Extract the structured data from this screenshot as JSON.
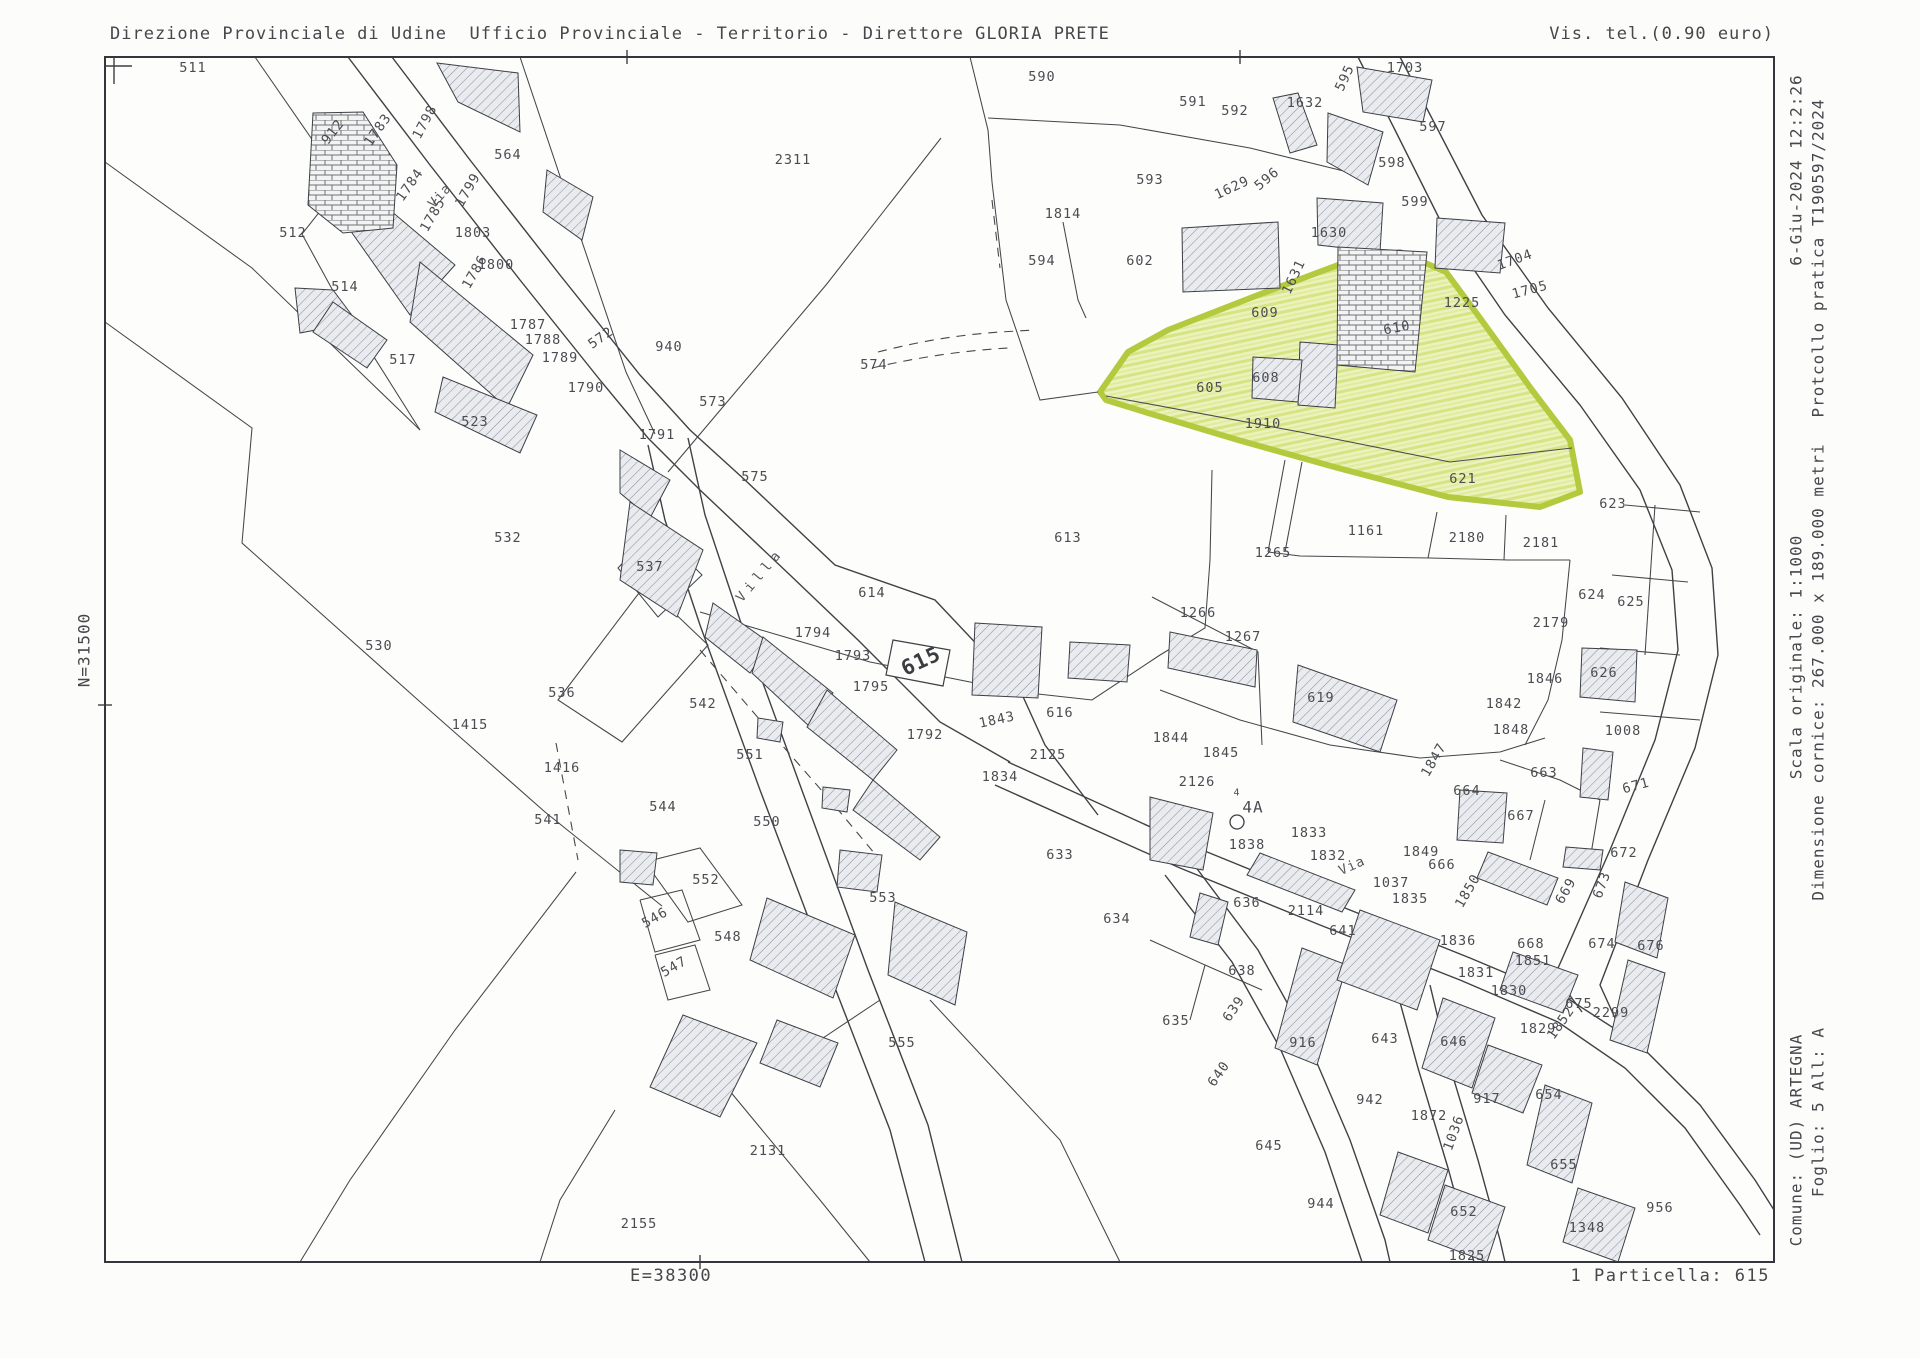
{
  "header": {
    "title_left": "Direzione Provinciale di Udine  Ufficio Provinciale - Territorio - Direttore GLORIA PRETE",
    "title_right": "Vis. tel.(0.90 euro)"
  },
  "right_margin": {
    "date_time": "6-Giu-2024 12:2:26",
    "protocol": "Protcollo pratica T190597/2024",
    "scale": "Scala originale: 1:1000",
    "frame_size": "Dimensione cornice: 267.000 x 189.000 metri",
    "comune": "Comune: (UD) ARTEGNA",
    "foglio": "Foglio: 5 All: A"
  },
  "left_margin": {
    "north_coord": "N=31500"
  },
  "footer": {
    "east_coord": "E=38300",
    "particella": "1 Particella: 615"
  },
  "map": {
    "highlighted_parcel": "621",
    "target_parcel": "615",
    "highlight_fill": "#e7efad",
    "highlight_stroke": "#b3c93e",
    "line_color": "#3f4146",
    "labels": [
      {
        "t": "511",
        "x": 193,
        "y": 68
      },
      {
        "t": "912",
        "x": 333,
        "y": 132,
        "r": -52
      },
      {
        "t": "1783",
        "x": 378,
        "y": 130,
        "r": -55
      },
      {
        "t": "1798",
        "x": 425,
        "y": 122,
        "r": -62
      },
      {
        "t": "564",
        "x": 508,
        "y": 155
      },
      {
        "t": "1784",
        "x": 410,
        "y": 185,
        "r": -55
      },
      {
        "t": "Via",
        "x": 440,
        "y": 196,
        "r": -48,
        "cls": "road-label"
      },
      {
        "t": "1799",
        "x": 468,
        "y": 190,
        "r": -60
      },
      {
        "t": "512",
        "x": 293,
        "y": 233
      },
      {
        "t": "1785",
        "x": 433,
        "y": 215,
        "r": -60
      },
      {
        "t": "1803",
        "x": 473,
        "y": 233
      },
      {
        "t": "1800",
        "x": 496,
        "y": 265
      },
      {
        "t": "514",
        "x": 345,
        "y": 287
      },
      {
        "t": "1786",
        "x": 475,
        "y": 272,
        "r": -60
      },
      {
        "t": "1787",
        "x": 528,
        "y": 325
      },
      {
        "t": "1788",
        "x": 543,
        "y": 340
      },
      {
        "t": "1789",
        "x": 560,
        "y": 358
      },
      {
        "t": "572",
        "x": 601,
        "y": 338,
        "r": -35
      },
      {
        "t": "517",
        "x": 403,
        "y": 360
      },
      {
        "t": "1790",
        "x": 586,
        "y": 388
      },
      {
        "t": "523",
        "x": 475,
        "y": 422
      },
      {
        "t": "590",
        "x": 1042,
        "y": 77
      },
      {
        "t": "2311",
        "x": 793,
        "y": 160
      },
      {
        "t": "593",
        "x": 1150,
        "y": 180
      },
      {
        "t": "1814",
        "x": 1063,
        "y": 214
      },
      {
        "t": "594",
        "x": 1042,
        "y": 261
      },
      {
        "t": "602",
        "x": 1140,
        "y": 261
      },
      {
        "t": "940",
        "x": 669,
        "y": 347
      },
      {
        "t": "573",
        "x": 713,
        "y": 402
      },
      {
        "t": "574",
        "x": 874,
        "y": 365
      },
      {
        "t": "1791",
        "x": 657,
        "y": 435
      },
      {
        "t": "575",
        "x": 755,
        "y": 477
      },
      {
        "t": "591",
        "x": 1193,
        "y": 102
      },
      {
        "t": "592",
        "x": 1235,
        "y": 111
      },
      {
        "t": "1632",
        "x": 1305,
        "y": 103
      },
      {
        "t": "595",
        "x": 1345,
        "y": 78,
        "r": -65
      },
      {
        "t": "1703",
        "x": 1405,
        "y": 68
      },
      {
        "t": "597",
        "x": 1433,
        "y": 127
      },
      {
        "t": "598",
        "x": 1392,
        "y": 163
      },
      {
        "t": "1629",
        "x": 1232,
        "y": 188,
        "r": -25
      },
      {
        "t": "596",
        "x": 1267,
        "y": 179,
        "r": -40
      },
      {
        "t": "599",
        "x": 1415,
        "y": 202
      },
      {
        "t": "1630",
        "x": 1329,
        "y": 233
      },
      {
        "t": "1631",
        "x": 1294,
        "y": 277,
        "r": -65
      },
      {
        "t": "609",
        "x": 1265,
        "y": 313
      },
      {
        "t": "1704",
        "x": 1515,
        "y": 260,
        "r": -20
      },
      {
        "t": "1705",
        "x": 1530,
        "y": 290,
        "r": -15
      },
      {
        "t": "1225",
        "x": 1462,
        "y": 303
      },
      {
        "t": "610",
        "x": 1397,
        "y": 328,
        "r": -10
      },
      {
        "t": "608",
        "x": 1266,
        "y": 378
      },
      {
        "t": "605",
        "x": 1210,
        "y": 388
      },
      {
        "t": "1910",
        "x": 1263,
        "y": 424
      },
      {
        "t": "621",
        "x": 1463,
        "y": 479
      },
      {
        "t": "623",
        "x": 1613,
        "y": 504
      },
      {
        "t": "532",
        "x": 508,
        "y": 538
      },
      {
        "t": "537",
        "x": 650,
        "y": 567
      },
      {
        "t": "530",
        "x": 379,
        "y": 646
      },
      {
        "t": "536",
        "x": 562,
        "y": 693
      },
      {
        "t": "1415",
        "x": 470,
        "y": 725
      },
      {
        "t": "1416",
        "x": 562,
        "y": 768
      },
      {
        "t": "541",
        "x": 548,
        "y": 820
      },
      {
        "t": "Villa",
        "x": 760,
        "y": 575,
        "r": -50,
        "cls": "road-label",
        "sp": 5
      },
      {
        "t": "613",
        "x": 1068,
        "y": 538
      },
      {
        "t": "614",
        "x": 872,
        "y": 593
      },
      {
        "t": "1794",
        "x": 813,
        "y": 633
      },
      {
        "t": "1793",
        "x": 853,
        "y": 656
      },
      {
        "t": "1795",
        "x": 871,
        "y": 687
      },
      {
        "t": "615",
        "x": 921,
        "y": 661,
        "r": -25,
        "s": 21,
        "cls": "target-parcel-label"
      },
      {
        "t": "542",
        "x": 703,
        "y": 704
      },
      {
        "t": "1792",
        "x": 925,
        "y": 735
      },
      {
        "t": "551",
        "x": 750,
        "y": 755
      },
      {
        "t": "616",
        "x": 1060,
        "y": 713
      },
      {
        "t": "1843",
        "x": 997,
        "y": 720,
        "r": -12
      },
      {
        "t": "544",
        "x": 663,
        "y": 807
      },
      {
        "t": "550",
        "x": 767,
        "y": 822
      },
      {
        "t": "2125",
        "x": 1048,
        "y": 755
      },
      {
        "t": "1834",
        "x": 1000,
        "y": 777
      },
      {
        "t": "1161",
        "x": 1366,
        "y": 531
      },
      {
        "t": "2180",
        "x": 1467,
        "y": 538
      },
      {
        "t": "2181",
        "x": 1541,
        "y": 543
      },
      {
        "t": "1265",
        "x": 1273,
        "y": 553
      },
      {
        "t": "624",
        "x": 1592,
        "y": 595
      },
      {
        "t": "625",
        "x": 1631,
        "y": 602
      },
      {
        "t": "2179",
        "x": 1551,
        "y": 623
      },
      {
        "t": "1266",
        "x": 1198,
        "y": 613
      },
      {
        "t": "1267",
        "x": 1243,
        "y": 637
      },
      {
        "t": "626",
        "x": 1604,
        "y": 673
      },
      {
        "t": "1846",
        "x": 1545,
        "y": 679
      },
      {
        "t": "619",
        "x": 1321,
        "y": 698
      },
      {
        "t": "1842",
        "x": 1504,
        "y": 704
      },
      {
        "t": "1848",
        "x": 1511,
        "y": 730
      },
      {
        "t": "1008",
        "x": 1623,
        "y": 731
      },
      {
        "t": "1844",
        "x": 1171,
        "y": 738
      },
      {
        "t": "1845",
        "x": 1221,
        "y": 753
      },
      {
        "t": "1847",
        "x": 1434,
        "y": 760,
        "r": -60
      },
      {
        "t": "2126",
        "x": 1197,
        "y": 782
      },
      {
        "t": "4A",
        "x": 1253,
        "y": 807,
        "s": 16,
        "cls": "map-symbol-label"
      },
      {
        "t": "4",
        "x": 1237,
        "y": 793,
        "s": 10,
        "cls": "map-symbol-label"
      },
      {
        "t": "663",
        "x": 1544,
        "y": 773
      },
      {
        "t": "664",
        "x": 1467,
        "y": 791
      },
      {
        "t": "667",
        "x": 1521,
        "y": 816
      },
      {
        "t": "671",
        "x": 1636,
        "y": 786,
        "r": -15
      },
      {
        "t": "1833",
        "x": 1309,
        "y": 833
      },
      {
        "t": "1838",
        "x": 1247,
        "y": 845
      },
      {
        "t": "1832",
        "x": 1328,
        "y": 856
      },
      {
        "t": "1849",
        "x": 1421,
        "y": 852
      },
      {
        "t": "666",
        "x": 1442,
        "y": 865
      },
      {
        "t": "672",
        "x": 1624,
        "y": 853
      },
      {
        "t": "552",
        "x": 706,
        "y": 880
      },
      {
        "t": "546",
        "x": 655,
        "y": 918,
        "r": -30
      },
      {
        "t": "548",
        "x": 728,
        "y": 937
      },
      {
        "t": "547",
        "x": 674,
        "y": 967,
        "r": -30
      },
      {
        "t": "553",
        "x": 883,
        "y": 898
      },
      {
        "t": "555",
        "x": 902,
        "y": 1043
      },
      {
        "t": "2131",
        "x": 768,
        "y": 1151
      },
      {
        "t": "2155",
        "x": 639,
        "y": 1224
      },
      {
        "t": "633",
        "x": 1060,
        "y": 855
      },
      {
        "t": "634",
        "x": 1117,
        "y": 919
      },
      {
        "t": "Via",
        "x": 1352,
        "y": 866,
        "r": -24,
        "cls": "road-label"
      },
      {
        "t": "1850",
        "x": 1468,
        "y": 891,
        "r": -60
      },
      {
        "t": "1037",
        "x": 1391,
        "y": 883
      },
      {
        "t": "1835",
        "x": 1410,
        "y": 899
      },
      {
        "t": "636",
        "x": 1247,
        "y": 903
      },
      {
        "t": "2114",
        "x": 1306,
        "y": 911
      },
      {
        "t": "641",
        "x": 1343,
        "y": 931
      },
      {
        "t": "1836",
        "x": 1458,
        "y": 941
      },
      {
        "t": "668",
        "x": 1531,
        "y": 944
      },
      {
        "t": "669",
        "x": 1566,
        "y": 891,
        "r": -60
      },
      {
        "t": "673",
        "x": 1602,
        "y": 885,
        "r": -70
      },
      {
        "t": "676",
        "x": 1651,
        "y": 946
      },
      {
        "t": "674",
        "x": 1602,
        "y": 944
      },
      {
        "t": "1851",
        "x": 1533,
        "y": 961
      },
      {
        "t": "638",
        "x": 1242,
        "y": 971
      },
      {
        "t": "639",
        "x": 1234,
        "y": 1009,
        "r": -55
      },
      {
        "t": "1831",
        "x": 1476,
        "y": 973
      },
      {
        "t": "1830",
        "x": 1509,
        "y": 991
      },
      {
        "t": "675",
        "x": 1579,
        "y": 1004
      },
      {
        "t": "2299",
        "x": 1611,
        "y": 1013
      },
      {
        "t": "635",
        "x": 1176,
        "y": 1021
      },
      {
        "t": "916",
        "x": 1303,
        "y": 1043
      },
      {
        "t": "643",
        "x": 1385,
        "y": 1039
      },
      {
        "t": "646",
        "x": 1454,
        "y": 1042
      },
      {
        "t": "1852",
        "x": 1561,
        "y": 1023,
        "r": -55
      },
      {
        "t": "1829",
        "x": 1538,
        "y": 1029
      },
      {
        "t": "640",
        "x": 1219,
        "y": 1074,
        "r": -55
      },
      {
        "t": "654",
        "x": 1549,
        "y": 1095
      },
      {
        "t": "942",
        "x": 1370,
        "y": 1100
      },
      {
        "t": "917",
        "x": 1487,
        "y": 1099
      },
      {
        "t": "1872",
        "x": 1429,
        "y": 1116
      },
      {
        "t": "1036",
        "x": 1454,
        "y": 1133,
        "r": -70
      },
      {
        "t": "645",
        "x": 1269,
        "y": 1146
      },
      {
        "t": "655",
        "x": 1564,
        "y": 1165
      },
      {
        "t": "944",
        "x": 1321,
        "y": 1204
      },
      {
        "t": "652",
        "x": 1464,
        "y": 1212
      },
      {
        "t": "956",
        "x": 1660,
        "y": 1208
      },
      {
        "t": "1348",
        "x": 1587,
        "y": 1228
      },
      {
        "t": "1825",
        "x": 1467,
        "y": 1256
      }
    ]
  }
}
